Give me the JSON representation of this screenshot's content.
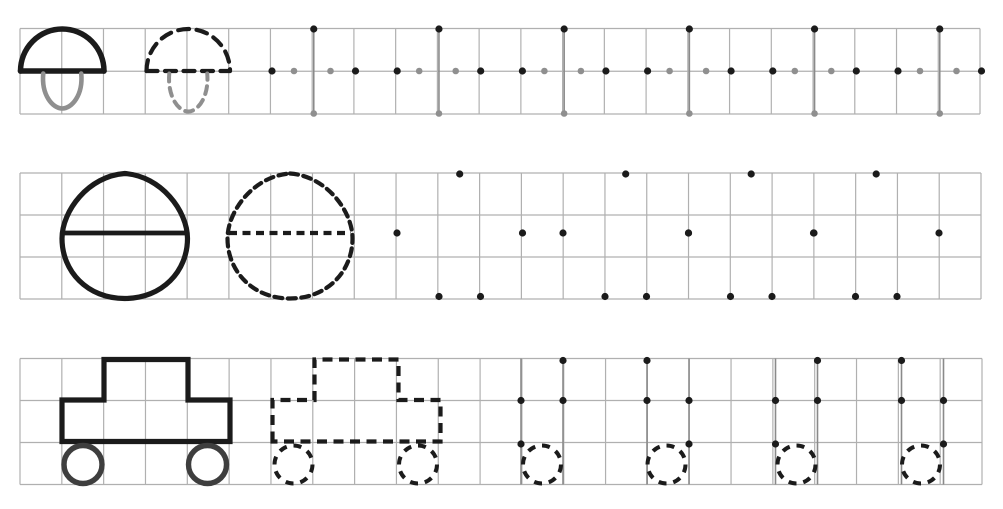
{
  "canvas": {
    "width": 1003,
    "height": 509,
    "background": "#ffffff"
  },
  "palette": {
    "ink": "#1b1b1b",
    "muted": "#8f8f8f",
    "grid": "#b0b0b0",
    "guide": "#8a8a8a",
    "wheel": "#3e3e3e"
  },
  "dot_radius": {
    "ink": 3.6,
    "muted": 3.3
  },
  "dash": {
    "mushroom_cap": "11 7.5",
    "mushroom_stem": "8 6.5",
    "egg": "8 5.5",
    "car": "10 6.5",
    "wheel": "8 6.9"
  },
  "bands": [
    {
      "name": "mushroom",
      "grid": {
        "left": 20,
        "top": 28.5,
        "right": 980,
        "bottom": 114,
        "cols": 23,
        "rows": 2
      },
      "shape": {
        "baseY": 71,
        "apexY": 29,
        "stemTopY": 73.5,
        "stemBottomY": 108.5,
        "stemHalfWidth": 19
      },
      "examples": [
        {
          "style": "solid",
          "left": 20.5,
          "right": 104
        },
        {
          "style": "dashed",
          "left": 146.5,
          "right": 230
        }
      ],
      "dot_groups": {
        "lefts": [
          272,
          397.2,
          522.4,
          647.6,
          772.8,
          898
        ],
        "ink_dots": [
          [
            0,
            71
          ],
          [
            83.5,
            71
          ],
          [
            41.75,
            29
          ]
        ],
        "muted_dots": [
          [
            22,
            71
          ],
          [
            58.5,
            71
          ],
          [
            41.75,
            113.5
          ]
        ],
        "guide_dx": [
          41.75
        ],
        "wheel_offsets": []
      }
    },
    {
      "name": "egg",
      "grid": {
        "left": 20,
        "top": 173,
        "right": 981,
        "bottom": 299,
        "cols": 23,
        "rows": 3
      },
      "shape": {
        "top": 173.5,
        "bottom": 298.5,
        "lineY": 233
      },
      "examples": [
        {
          "style": "solid",
          "left": 62,
          "right": 187.5
        },
        {
          "style": "dashed",
          "left": 227.5,
          "right": 352.5
        }
      ],
      "dot_groups": {
        "lefts": [
          397,
          563,
          688.5,
          813.5
        ],
        "ink_dots": [
          [
            0,
            233
          ],
          [
            125.5,
            233
          ],
          [
            62.7,
            174
          ],
          [
            42,
            296.5
          ],
          [
            83.5,
            296.5
          ]
        ],
        "muted_dots": [],
        "guide_dx": [],
        "wheel_offsets": []
      }
    },
    {
      "name": "car",
      "grid": {
        "left": 20,
        "top": 358.5,
        "right": 982,
        "bottom": 484.5,
        "cols": 23,
        "rows": 3
      },
      "shape": {
        "cabinTop": 359.5,
        "bodyTop": 400,
        "bodyBottom": 441.5,
        "bodyWidth": 168,
        "cabinOffset": 42,
        "cabinWidth": 84,
        "wheelY": 464.5,
        "wheelRadius": 19,
        "wheelOffsets": [
          21,
          145.5
        ]
      },
      "examples": [
        {
          "style": "solid",
          "left": 62
        },
        {
          "style": "dashed",
          "left": 272.5
        }
      ],
      "dot_groups": {
        "lefts": [
          521,
          775.5
        ],
        "ink_dots": [
          [
            42,
            360.5
          ],
          [
            126,
            360.5
          ],
          [
            0,
            400.5
          ],
          [
            42,
            400.5
          ],
          [
            126,
            400.5
          ],
          [
            168,
            400.5
          ],
          [
            0,
            444
          ],
          [
            168,
            444
          ]
        ],
        "muted_dots": [],
        "guide_dx": [
          0,
          42,
          126,
          168
        ],
        "wheel_offsets": [
          21,
          145.5
        ]
      }
    }
  ]
}
